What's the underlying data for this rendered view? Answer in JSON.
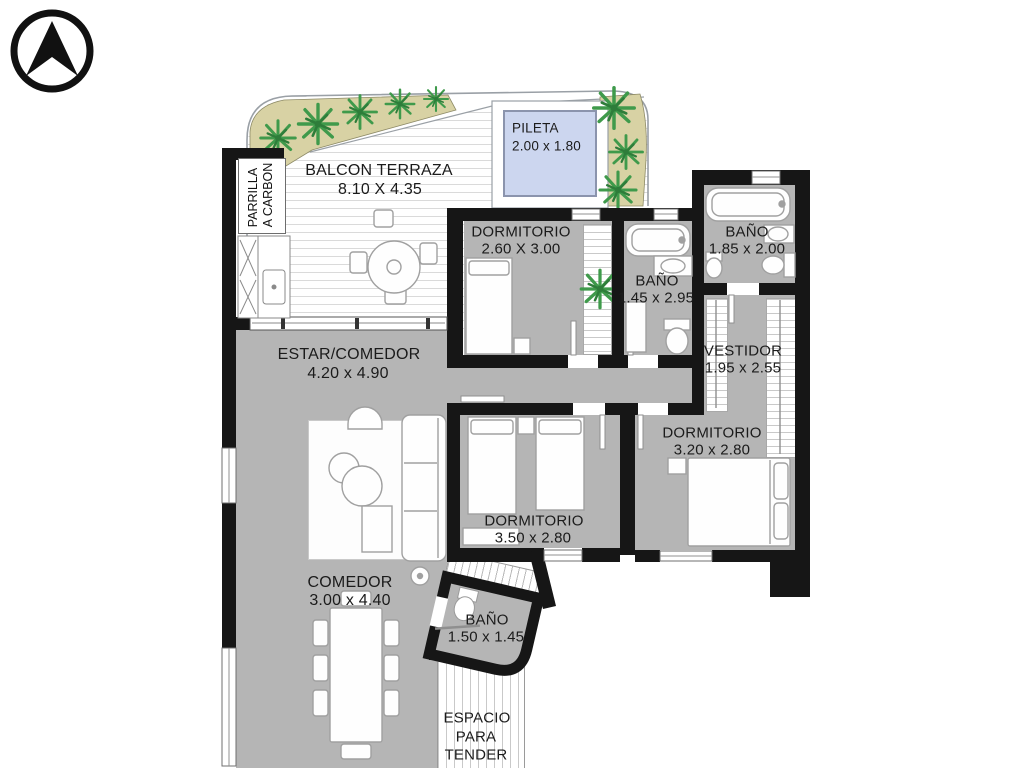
{
  "plan_title": "apartment floor plan",
  "compass": {
    "icon": "north-arrow"
  },
  "rooms": {
    "balcon_terraza": {
      "name": "BALCON TERRAZA",
      "dims": "8.10 X 4.35"
    },
    "pileta": {
      "name": "PILETA",
      "dims": "2.00 x 1.80"
    },
    "parrilla": {
      "line1": "PARRILLA",
      "line2": "A CARBON"
    },
    "dormitorio1": {
      "name": "DORMITORIO",
      "dims": "2.60 X 3.00"
    },
    "bano1": {
      "name": "BAÑO",
      "dims": "1.45 x 2.95"
    },
    "bano2": {
      "name": "BAÑO",
      "dims": "1.85 x 2.00"
    },
    "vestidor": {
      "name": "VESTIDOR",
      "dims": "1.95 x 2.55"
    },
    "estar_comedor": {
      "name": "ESTAR/COMEDOR",
      "dims": "4.20 x 4.90"
    },
    "dormitorio2": {
      "name": "DORMITORIO",
      "dims": "3.20 x 2.80"
    },
    "dormitorio3": {
      "name": "DORMITORIO",
      "dims": "3.50 x 2.80"
    },
    "comedor": {
      "name": "COMEDOR",
      "dims": "3.00 x 4.40"
    },
    "bano3": {
      "name": "BAÑO",
      "dims": "1.50 x 1.45"
    },
    "tender": {
      "line1": "ESPACIO",
      "line2": "PARA",
      "line3": "TENDER"
    }
  },
  "colors": {
    "wall": "#161616",
    "floor": "#b5b5b5",
    "pool_fill": "#ccd6ef",
    "pool_border": "#8b94ad",
    "plant_green": "#3f9a4b",
    "planter_tan": "#d8d2a4",
    "deck_line": "#dadada",
    "furniture_stroke": "#a0a0a0"
  }
}
